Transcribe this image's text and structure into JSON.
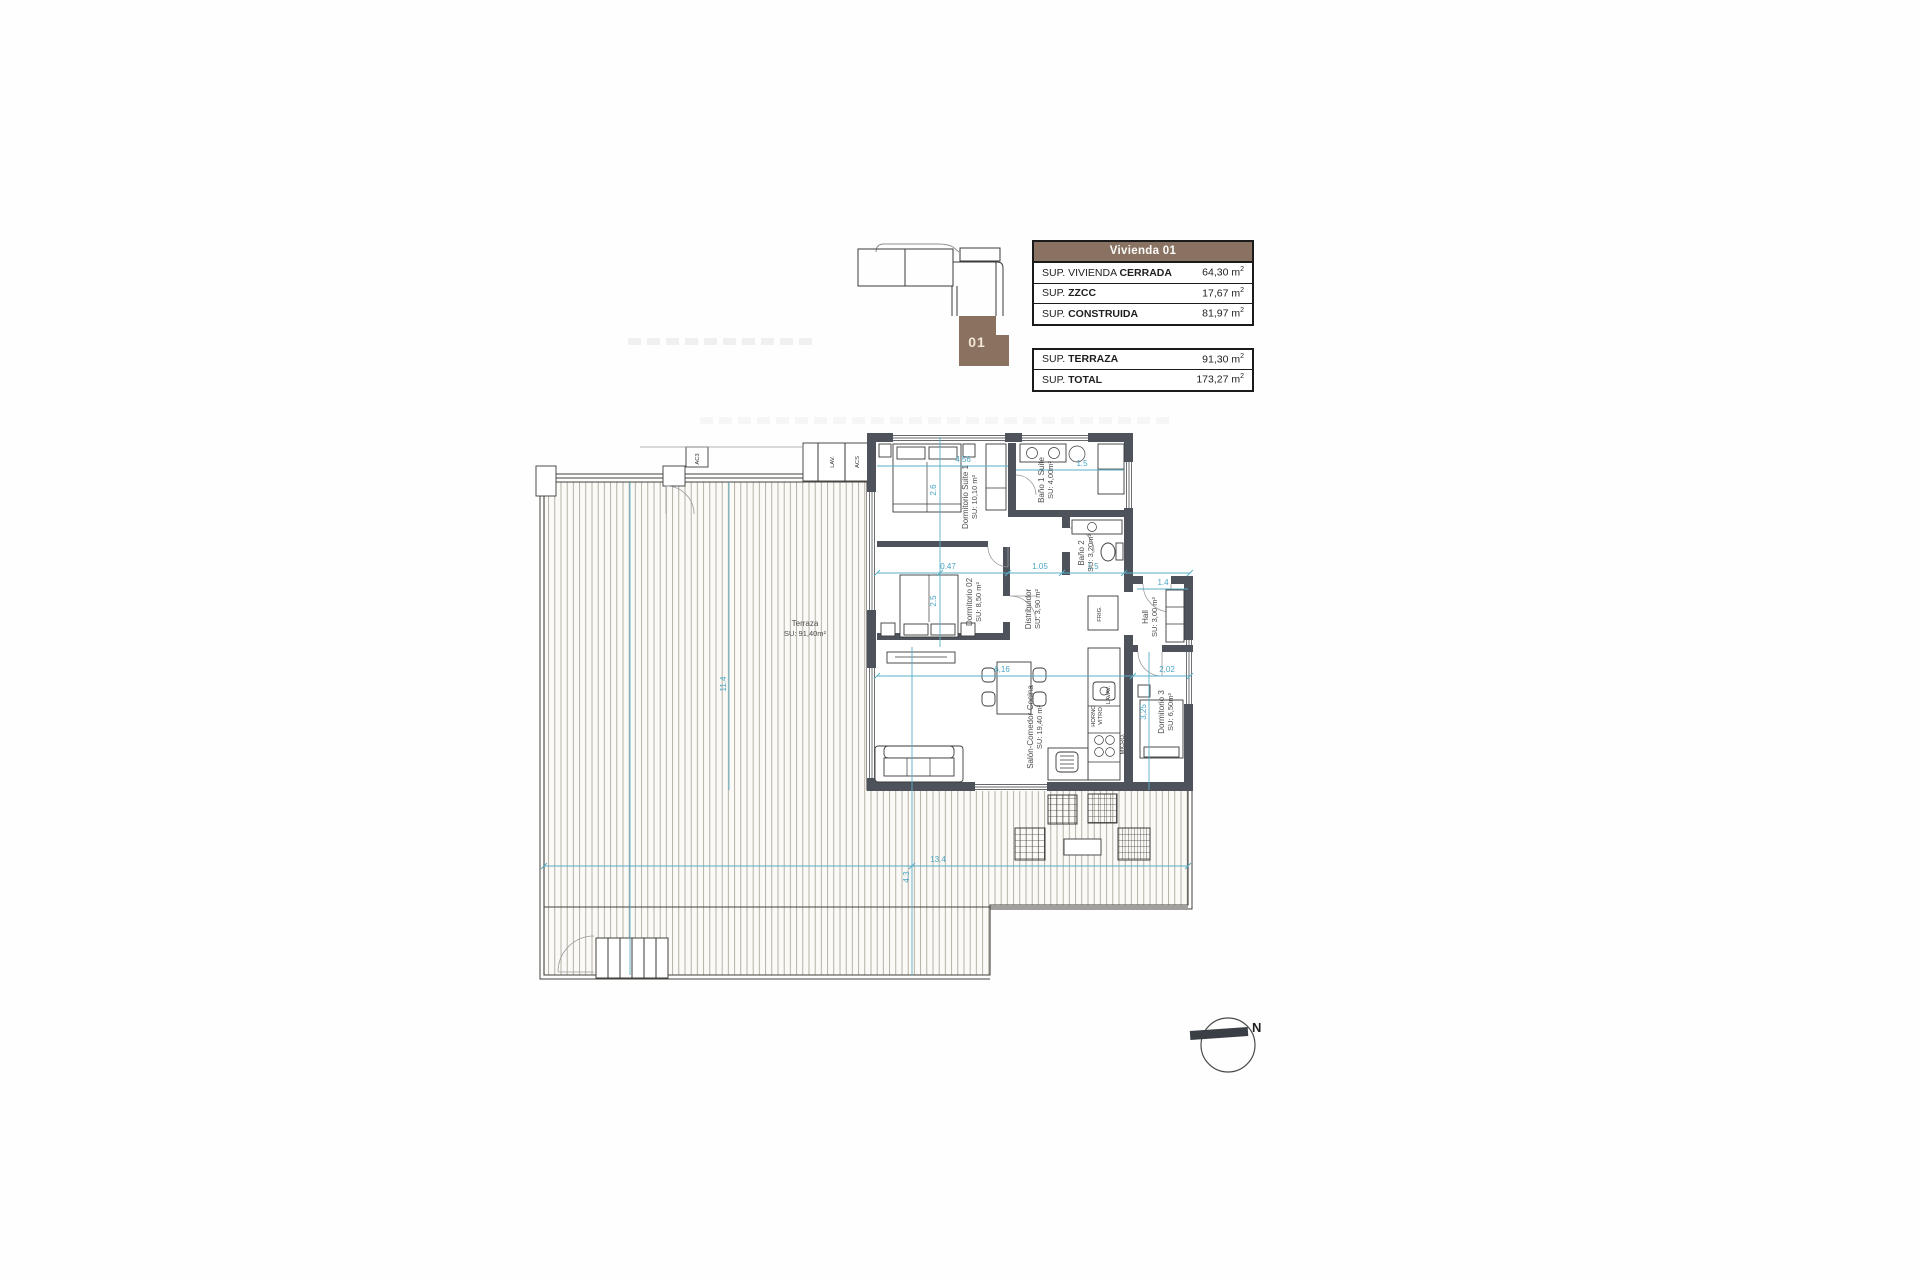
{
  "tables": {
    "sup_exponent": "2",
    "unit": {
      "header": "Vivienda 01",
      "rows": [
        {
          "pre": "SUP. VIVIENDA ",
          "bold": "CERRADA",
          "value": "64,30 m"
        },
        {
          "pre": "SUP. ",
          "bold": "ZZCC",
          "value": "17,67 m"
        },
        {
          "pre": "SUP. ",
          "bold": "CONSTRUIDA",
          "value": "81,97 m"
        }
      ]
    },
    "totals": {
      "rows": [
        {
          "pre": "SUP. ",
          "bold": "TERRAZA",
          "value": "91,30 m"
        },
        {
          "pre": "SUP. ",
          "bold": "TOTAL",
          "value": "173,27 m"
        }
      ]
    }
  },
  "key_plan": {
    "unit_number": "01"
  },
  "plan": {
    "rooms": {
      "suite1": {
        "name": "Dormitorio Suite 1",
        "area": "SU: 10,10 m²"
      },
      "bano1": {
        "name": "Baño 1 Suite",
        "area": "SU: 4,00m²"
      },
      "bano2": {
        "name": "Baño 2",
        "area": "SU: 3,20m²"
      },
      "dorm2": {
        "name": "Dormitorio 02",
        "area": "SU: 8,50 m²"
      },
      "distribuidor": {
        "name": "Distribuidor",
        "area": "SU: 3,90 m²"
      },
      "hall": {
        "name": "Hall",
        "area": "SU: 3,00 m²"
      },
      "dorm3": {
        "name": "Dormitorio 3",
        "area": "SU: 6,50m²"
      },
      "salon": {
        "name": "Salón-Comedor-Cocina",
        "area": "SU: 19,40 m²"
      },
      "terraza": {
        "name": "Terraza",
        "area": "SU: 91,40m²"
      }
    },
    "fixtures": {
      "ac": "AC3",
      "lav": "LAV.",
      "acs": "ACS",
      "frig": "FRIG.",
      "lavav": "LAVAV.",
      "horno": "HORNO",
      "vitro": "VITRO",
      "micro": "MICRO."
    },
    "dims": {
      "suite_w": "4.56",
      "suite_d": "2.6",
      "bano1_w": "1.5",
      "seg1": "0.47",
      "seg2": "1.05",
      "seg3": "1.5",
      "hall_w": "1.4",
      "dorm2_d": "2.5",
      "salon_w": "6,16",
      "dorm3_w": "2,02",
      "dorm3_d": "3,25",
      "terraza_d": "11.4",
      "terraza_w": "13.4",
      "terraza_bottom": "4.3"
    },
    "compass_north": "N"
  },
  "colors": {
    "accent_brown": "#8a7263",
    "wall_gray": "#4e535b",
    "dimension_cyan": "#57aec6"
  }
}
